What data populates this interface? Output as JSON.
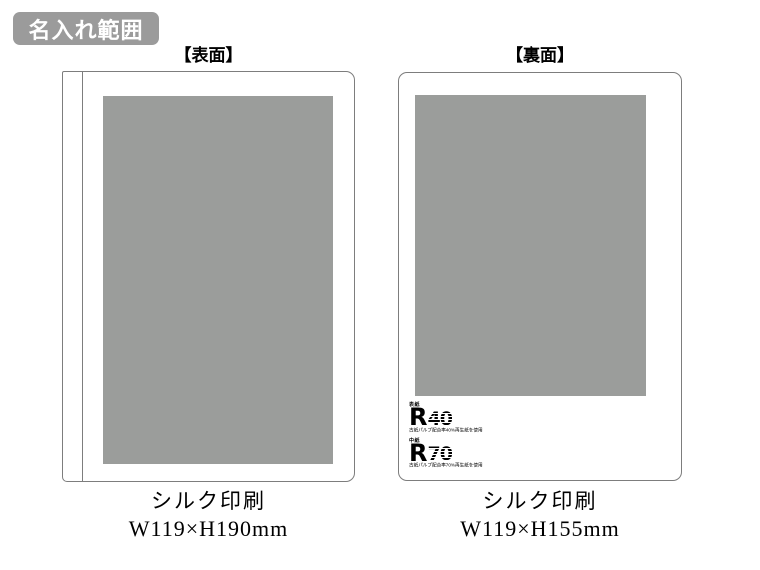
{
  "badge": {
    "label": "名入れ範囲"
  },
  "colors": {
    "badge_bg": "#9b9b9b",
    "print_area": "#9b9d9b",
    "line": "#7d7d7d",
    "ink": "#111111"
  },
  "front": {
    "header": "【表面】",
    "print_method": "シルク印刷",
    "print_size": "W119×H190mm"
  },
  "back": {
    "header": "【裏面】",
    "print_method": "シルク印刷",
    "print_size": "W119×H155mm",
    "recycle_marks": [
      {
        "label_top": "表紙",
        "mark_letter": "R",
        "number": "40",
        "caption": "古紙パルプ配合率40%再生紙を使用"
      },
      {
        "label_top": "中紙",
        "mark_letter": "R",
        "number": "70",
        "caption": "古紙パルプ配合率70%再生紙を使用"
      }
    ]
  }
}
